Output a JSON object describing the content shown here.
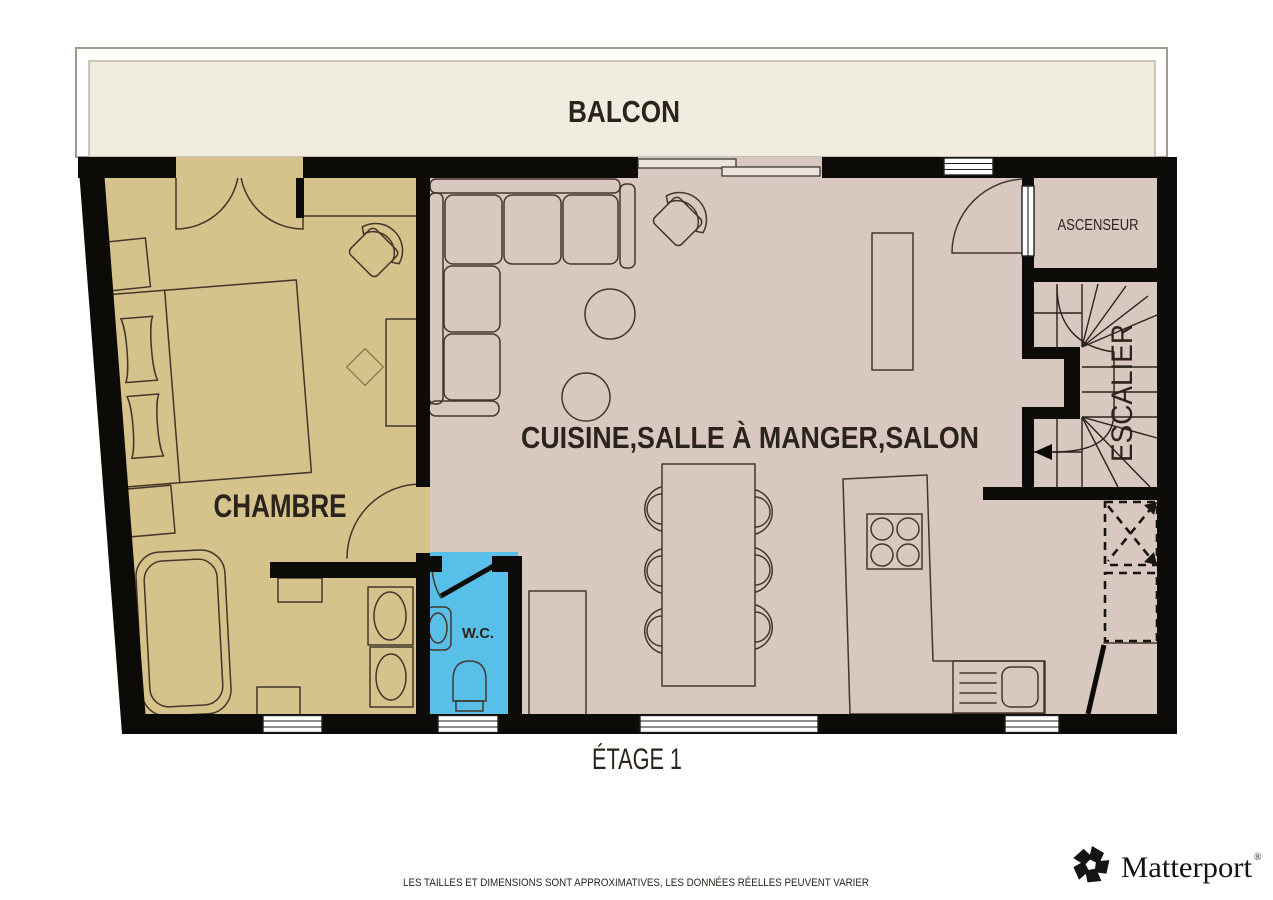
{
  "plan": {
    "floor_label": "ÉTAGE 1",
    "balcony_label": "BALCON",
    "bedroom_label": "CHAMBRE",
    "living_label": "CUISINE,SALLE À MANGER,SALON",
    "wc_label": "W.C.",
    "elevator_label": "ASCENSEUR",
    "stairs_label": "ESCALIER"
  },
  "colors": {
    "balcony": "#f0ecdf",
    "bedroom": "#d6c28b",
    "living": "#d8c8c0",
    "wc": "#58c0e8",
    "walls": "#0d0b08"
  },
  "footer": {
    "disclaimer": "LES TAILLES ET DIMENSIONS SONT APPROXIMATIVES, LES DONNÉES RÉELLES PEUVENT VARIER",
    "brand": "Matterport",
    "registered": "®"
  }
}
